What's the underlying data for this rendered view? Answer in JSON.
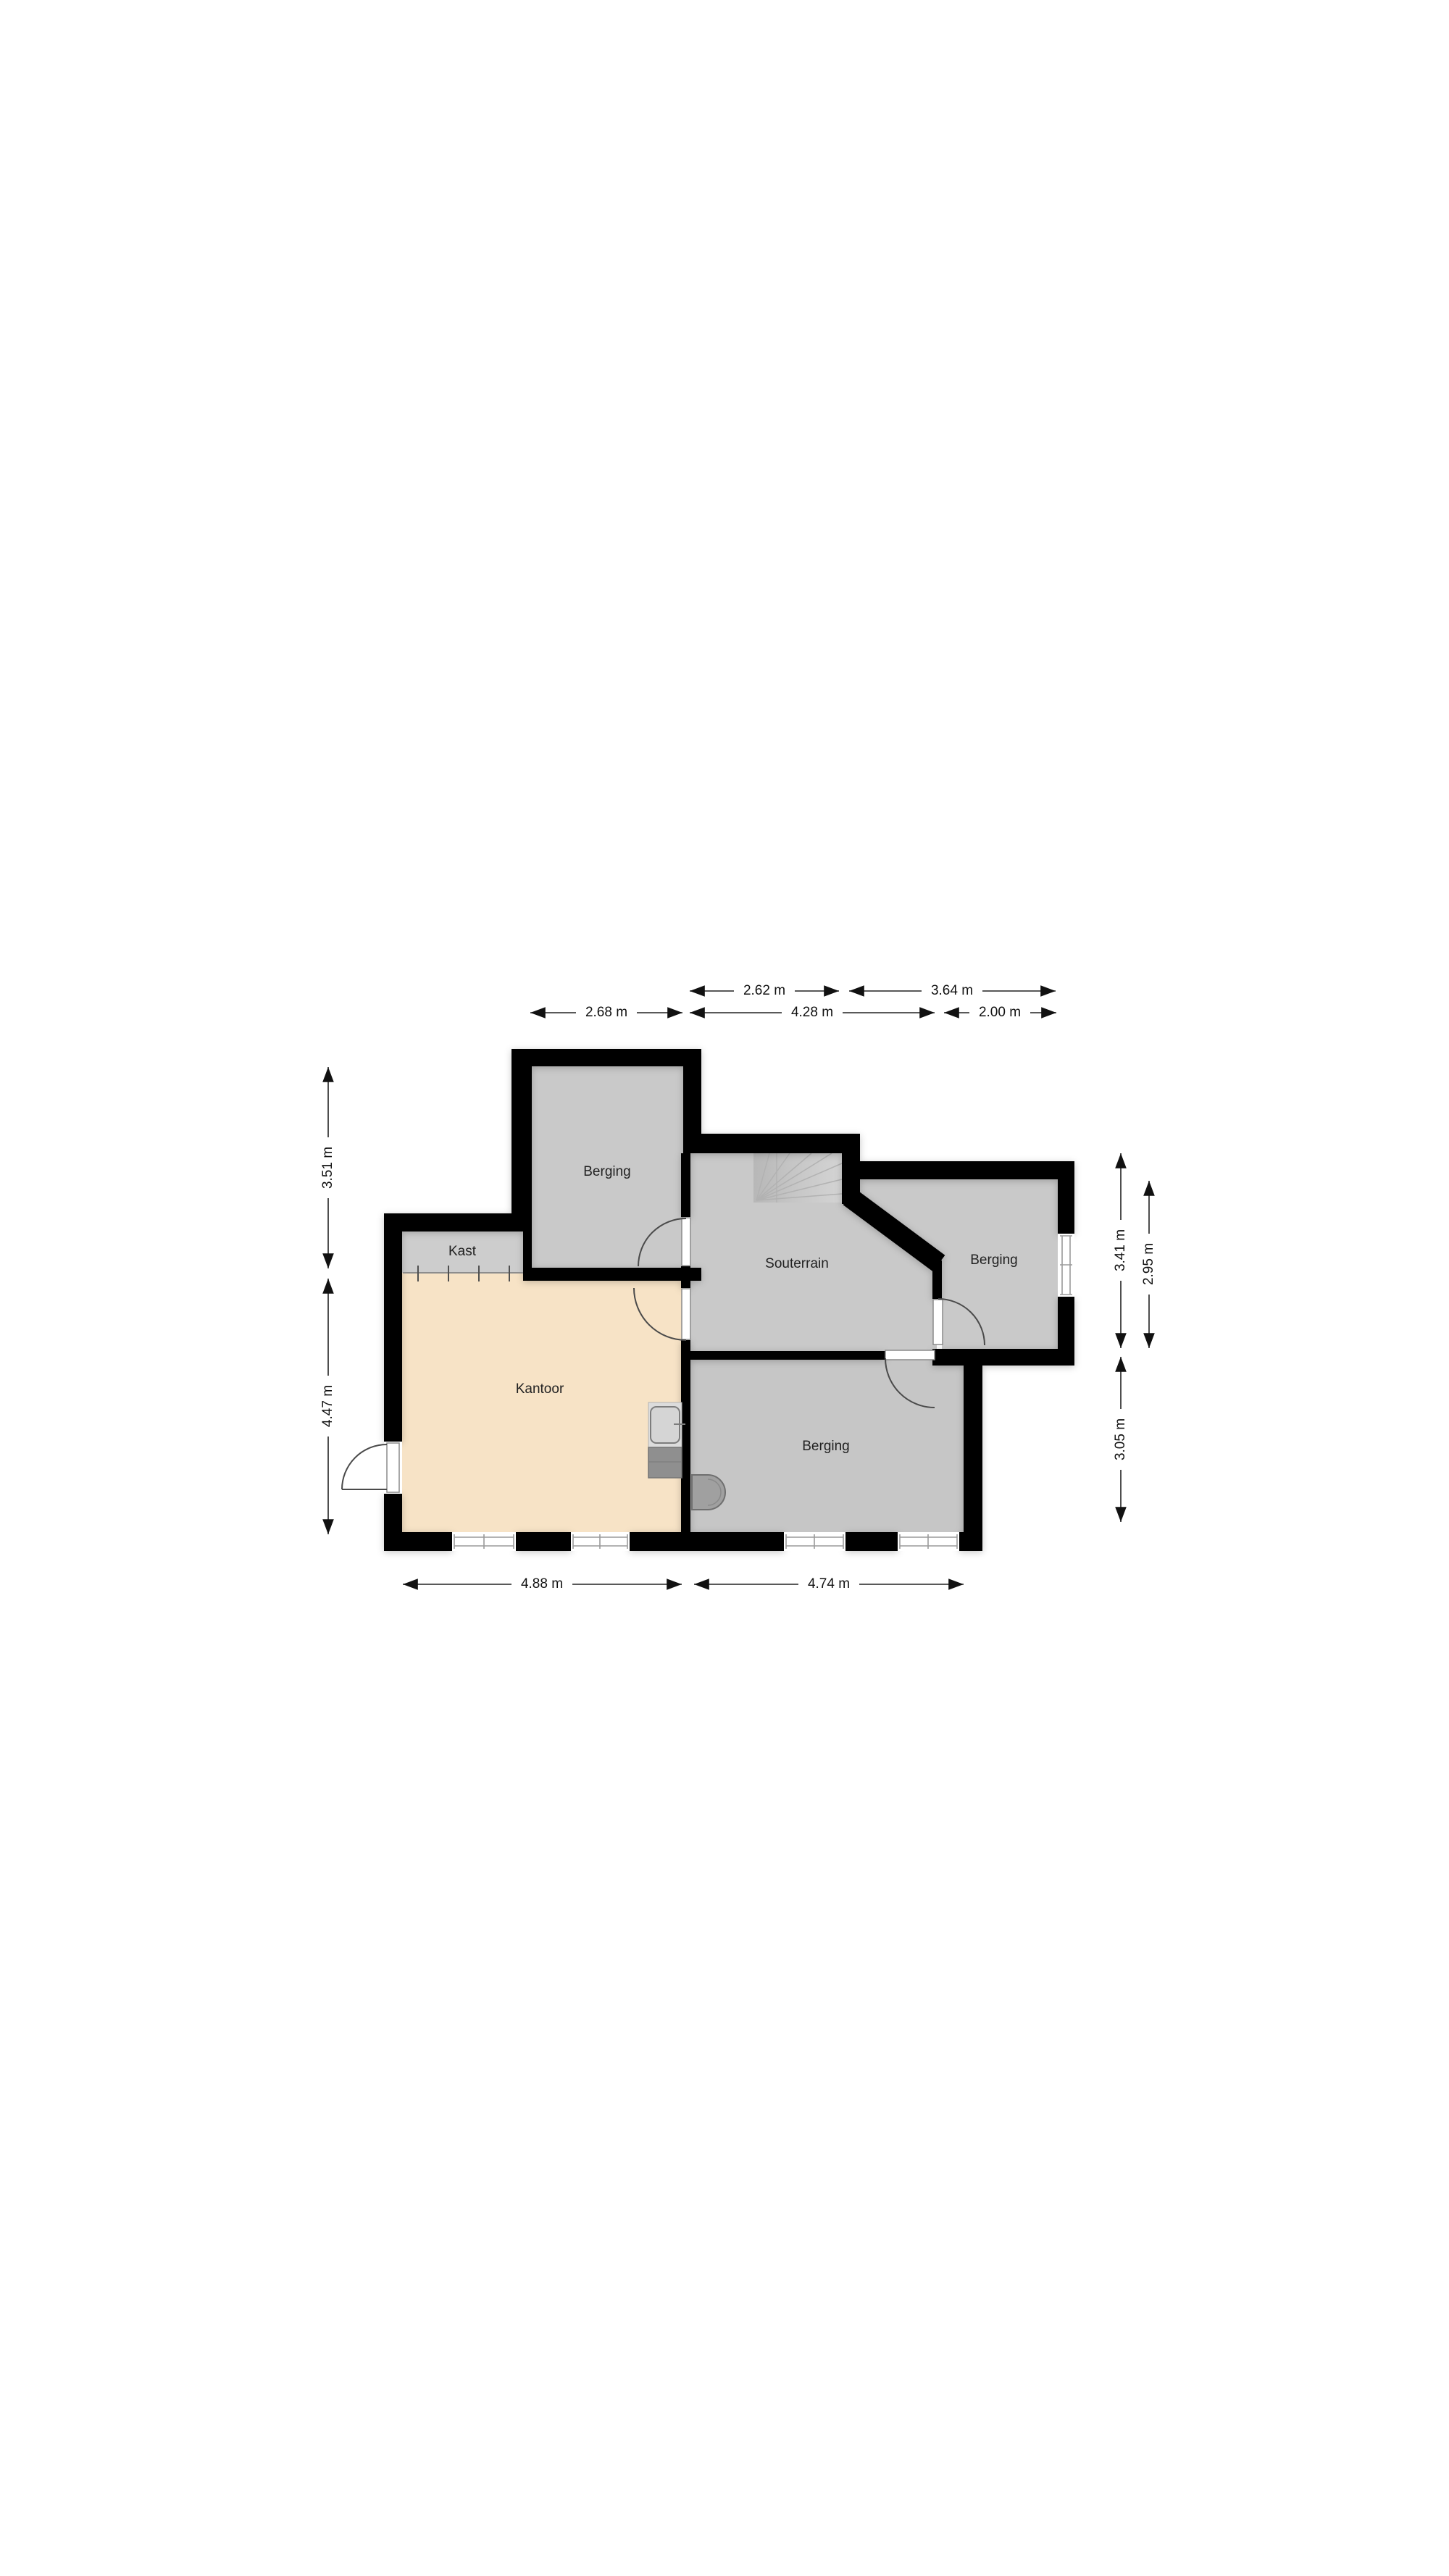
{
  "page": {
    "type": "floorplan",
    "background": "#ffffff"
  },
  "colors": {
    "wall": "#000000",
    "floor_gray": "#c9c9c9",
    "floor_gray_light": "#cdcdcd",
    "floor_gray_dark": "#c6c6c6",
    "floor_peach": "#f7e3c6",
    "stair_dark": "#bcbcbc",
    "stair_light": "#d3d3d3"
  },
  "rooms": {
    "berging_top": {
      "label": "Berging"
    },
    "kast": {
      "label": "Kast"
    },
    "souterrain": {
      "label": "Souterrain"
    },
    "berging_right": {
      "label": "Berging"
    },
    "kantoor": {
      "label": "Kantoor"
    },
    "berging_bottom": {
      "label": "Berging"
    }
  },
  "dims": {
    "top_a": "2.62 m",
    "top_b": "3.64 m",
    "top_c": "2.68 m",
    "top_d": "4.28 m",
    "top_e": "2.00 m",
    "left_a": "3.51 m",
    "left_b": "4.47 m",
    "right_a": "3.41 m",
    "right_b": "2.95 m",
    "right_c": "3.05 m",
    "bottom_a": "4.88 m",
    "bottom_b": "4.74 m"
  }
}
